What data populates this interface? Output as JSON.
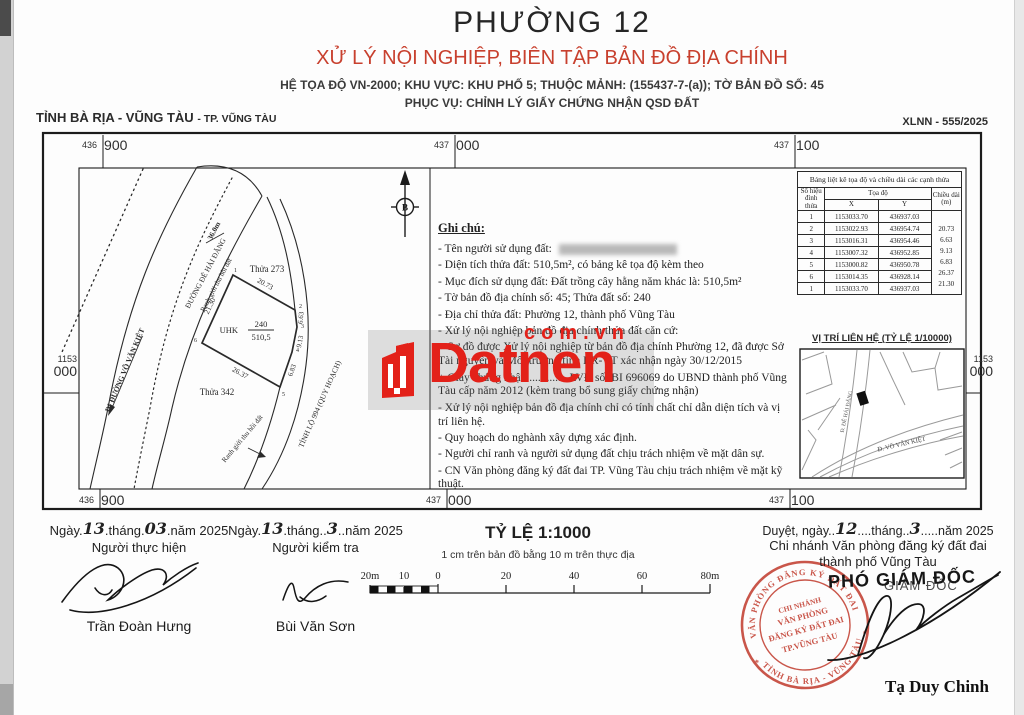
{
  "header": {
    "title": "PHƯỜNG 12",
    "subtitle": "XỬ LÝ NỘI NGHIỆP, BIÊN TẬP BẢN ĐỒ ĐỊA CHÍNH",
    "line3": "HỆ TỌA ĐỘ VN-2000; KHU VỰC: KHU PHỐ 5; THUỘC MẢNH: (155437-7-(a)); TỜ BẢN ĐỒ SỐ: 45",
    "line4": "PHỤC VỤ: CHỈNH LÝ GIẤY CHỨNG NHẬN QSD ĐẤT",
    "province_caption": "TỈNH BÀ RỊA - VŨNG TÀU",
    "city_caption": "- TP. VŨNG TÀU",
    "doc_number": "XLNN - 555/2025"
  },
  "map": {
    "north_label": "B",
    "coords": {
      "top": [
        [
          "436",
          "900"
        ],
        [
          "437",
          "000"
        ],
        [
          "437",
          "100"
        ]
      ],
      "bottom": [
        [
          "436",
          "900"
        ],
        [
          "437",
          "000"
        ],
        [
          "437",
          "100"
        ]
      ],
      "left": [
        "1153",
        "000"
      ],
      "right": [
        "1153",
        "000"
      ]
    },
    "labels": {
      "parcel_273": "Thửa 273",
      "parcel_342": "Thửa 342",
      "road_de_hai_dang": "ĐƯỜNG ĐÊ HẢI ĐĂNG",
      "road_width": "36.0m",
      "recovery_boundary_1": "Ranh giới thu hồi đất",
      "recovery_boundary_2": "Ranh giới thu hồi đất",
      "vo_van_kiet": "ĐI ĐƯỜNG VÕ VĂN KIỆT",
      "tl994": "TỈNH LỘ 994 (QUY HOẠCH)",
      "parcel_type": "UHK",
      "parcel_number": "240",
      "parcel_area": "510,5"
    },
    "edge_labels": [
      "20.73",
      "6.63",
      "9.13",
      "6.83",
      "26.37",
      "21.30"
    ],
    "vertex_labels": [
      "1",
      "2",
      "3",
      "4",
      "5",
      "6"
    ]
  },
  "notes": {
    "heading": "Ghi chú:",
    "items": [
      "- Tên người sử dụng đất:",
      "- Diện tích thửa đất: 510,5m², có bảng kê tọa độ kèm theo",
      "- Mục đích sử dụng đất: Đất trồng cây hằng năm khác là: 510,5m²",
      "- Tờ bản đồ địa chính số: 45; Thửa đất số: 240",
      "- Địa chỉ thửa đất: Phường 12, thành phố Vũng Tàu",
      "- Xử lý nội nghiệp bản đồ địa chính thửa đất căn cứ:",
      "+ Sơ đồ được Xử lý nội nghiệp từ bản đồ địa chính Phường 12, đã được Sở Tài nguyên và Môi trường tỉnh BR-VT xác nhận ngày 30/12/2015",
      "+ Giấy chứng nhận ............. LVĐ số: BI 696069 do UBND thành phố Vũng Tàu cấp năm 2012 (kèm trang bổ sung giấy chứng nhận)",
      "- Xử lý nội nghiệp bản đồ địa chính chỉ có tính chất chỉ dẫn diện tích và vị trí liên hệ.",
      "- Quy hoạch do nghành xây dựng xác định.",
      "- Người chỉ ranh và người sử dụng đất chịu trách nhiệm về mặt dân sự.",
      "- CN Văn phòng đăng ký đất đai TP. Vũng Tàu chịu trách nhiệm về mặt kỹ thuật."
    ]
  },
  "table": {
    "title": "Bảng liệt kê tọa độ và chiều dài các cạnh thửa",
    "col_vertex": "Số hiệu đỉnh thửa",
    "col_coords": "Tọa độ",
    "col_x": "X",
    "col_y": "Y",
    "col_len": "Chiều dài (m)",
    "rows": [
      {
        "id": "1",
        "x": "1153033.70",
        "y": "436937.03"
      },
      {
        "id": "2",
        "x": "1153022.93",
        "y": "436954.74"
      },
      {
        "id": "3",
        "x": "1153016.31",
        "y": "436954.46"
      },
      {
        "id": "4",
        "x": "1153007.32",
        "y": "436952.85"
      },
      {
        "id": "5",
        "x": "1153000.82",
        "y": "436950.78"
      },
      {
        "id": "6",
        "x": "1153014.35",
        "y": "436928.14"
      },
      {
        "id": "1",
        "x": "1153033.70",
        "y": "436937.03"
      }
    ],
    "lengths": [
      "20.73",
      "6.63",
      "9.13",
      "6.83",
      "26.37",
      "21.30"
    ]
  },
  "minimap": {
    "title": "VỊ TRÍ LIÊN HỆ (TỶ LỆ 1/10000)",
    "road1": "Đ. ĐÊ HẢI ĐĂNG",
    "road2": "Đ. VÕ VĂN KIỆT"
  },
  "footer": {
    "block1": {
      "prefix": "Ngày.",
      "day": "13",
      "mid": ".tháng.",
      "month": "03",
      "suffix": ".năm 2025",
      "role": "Người thực hiện",
      "name": "Trần Đoàn Hưng"
    },
    "block2": {
      "prefix": "Ngày.",
      "day": "13",
      "mid": ".tháng..",
      "month": "3",
      "suffix": "..năm 2025",
      "role": "Người kiểm tra",
      "name": "Bùi Văn Sơn"
    },
    "scale": {
      "title": "TỶ LỆ 1:1000",
      "subtitle": "1 cm trên bản đồ bằng 10 m trên thực địa",
      "ticks": [
        "20m",
        "10",
        "0",
        "20",
        "40",
        "60",
        "80m"
      ]
    },
    "approval": {
      "prefix": "Duyệt, ngày..",
      "day": "12",
      "mid": "....tháng..",
      "month": "3",
      "suffix": ".....năm 2025",
      "org1": "Chi nhánh Văn phòng đăng ký đất đai",
      "org2": "thành phố Vũng Tàu",
      "role_bg": "GIÁM ĐỐC",
      "role": "PHÓ GIÁM ĐỐC",
      "name": "Tạ Duy Chinh"
    },
    "stamp": {
      "ring_top": "VĂN PHÒNG ĐĂNG KÝ ĐẤT ĐAI",
      "ring_bottom": "TỈNH BÀ RỊA - VŨNG TÀU",
      "center": [
        "CHI NHÁNH",
        "VĂN PHÒNG",
        "ĐĂNG KÝ ĐẤT ĐAI",
        "TP.VŨNG TÀU"
      ],
      "star": "*",
      "color": "#c0392b"
    }
  },
  "watermark": {
    "text": "Datnen",
    "domain": "com.vn",
    "color": "#e32119"
  }
}
